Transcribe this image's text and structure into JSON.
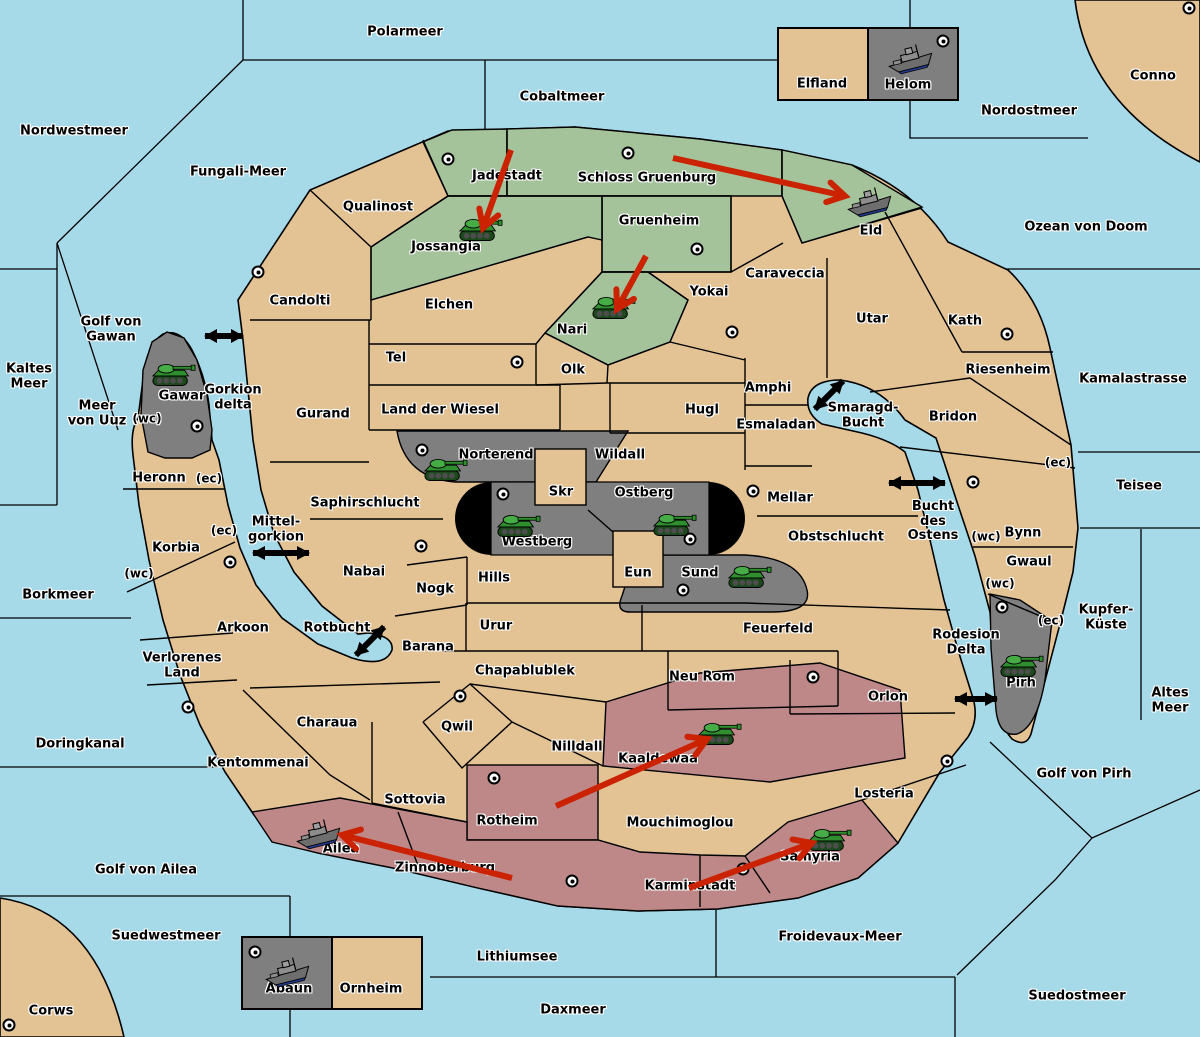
{
  "map_colors": {
    "sea": "#A6DAE8",
    "land": "#E3C294",
    "green": "#A4C39B",
    "red": "#BE8888",
    "gray": "#7F7F7F",
    "black": "#000000",
    "arrow_red": "#CB2201"
  },
  "sea_labels": [
    {
      "text": "Polarmeer",
      "x": 405,
      "y": 33
    },
    {
      "text": "Cobaltmeer",
      "x": 562,
      "y": 98
    },
    {
      "text": "Nordostmeer",
      "x": 1029,
      "y": 112
    },
    {
      "text": "Nordwestmeer",
      "x": 74,
      "y": 132
    },
    {
      "text": "Fungali-Meer",
      "x": 238,
      "y": 173
    },
    {
      "text": "Ozean von Doom",
      "x": 1086,
      "y": 228
    },
    {
      "text": "Kamalastrasse",
      "x": 1133,
      "y": 380
    },
    {
      "text": "Kaltes\nMeer",
      "x": 29,
      "y": 377
    },
    {
      "text": "Golf von\nGawan",
      "x": 111,
      "y": 330
    },
    {
      "text": "Meer\nvon Uuz",
      "x": 97,
      "y": 414
    },
    {
      "text": "Gorkion\ndelta",
      "x": 233,
      "y": 398
    },
    {
      "text": "Mittel-\ngorkion",
      "x": 276,
      "y": 530
    },
    {
      "text": "Teisee",
      "x": 1139,
      "y": 487
    },
    {
      "text": "Borkmeer",
      "x": 58,
      "y": 596
    },
    {
      "text": "Smaragd-\nBucht",
      "x": 863,
      "y": 416
    },
    {
      "text": "Bucht\ndes\nOstens",
      "x": 933,
      "y": 522
    },
    {
      "text": "Rotbucht",
      "x": 337,
      "y": 629
    },
    {
      "text": "Kupfer-\nKüste",
      "x": 1106,
      "y": 618
    },
    {
      "text": "Altes\nMeer",
      "x": 1170,
      "y": 701
    },
    {
      "text": "Rodesion\nDelta",
      "x": 966,
      "y": 643
    },
    {
      "text": "Doringkanal",
      "x": 80,
      "y": 745
    },
    {
      "text": "Golf von Pirh",
      "x": 1084,
      "y": 775
    },
    {
      "text": "Golf von Ailea",
      "x": 146,
      "y": 871
    },
    {
      "text": "Suedwestmeer",
      "x": 166,
      "y": 937
    },
    {
      "text": "Froidevaux-Meer",
      "x": 840,
      "y": 938
    },
    {
      "text": "Lithiumsee",
      "x": 517,
      "y": 958
    },
    {
      "text": "Daxmeer",
      "x": 573,
      "y": 1011
    },
    {
      "text": "Suedostmeer",
      "x": 1077,
      "y": 997
    }
  ],
  "territories": [
    {
      "name": "Conno",
      "x": 1153,
      "y": 77,
      "kind": "neutral"
    },
    {
      "name": "Corws",
      "x": 51,
      "y": 1012,
      "kind": "neutral"
    },
    {
      "name": "Elfland",
      "x": 822,
      "y": 85,
      "kind": "neutral"
    },
    {
      "name": "Helom",
      "x": 908,
      "y": 86,
      "kind": "gray"
    },
    {
      "name": "Abaun",
      "x": 289,
      "y": 990,
      "kind": "gray"
    },
    {
      "name": "Ornheim",
      "x": 371,
      "y": 990,
      "kind": "neutral"
    },
    {
      "name": "Qualinost",
      "x": 378,
      "y": 208,
      "kind": "neutral"
    },
    {
      "name": "Candolti",
      "x": 300,
      "y": 302,
      "kind": "neutral"
    },
    {
      "name": "Jadestadt",
      "x": 507,
      "y": 177,
      "kind": "green"
    },
    {
      "name": "Schloss Gruenburg",
      "x": 647,
      "y": 179,
      "kind": "green"
    },
    {
      "name": "Gruenheim",
      "x": 659,
      "y": 222,
      "kind": "green"
    },
    {
      "name": "Jossangia",
      "x": 446,
      "y": 248,
      "kind": "green"
    },
    {
      "name": "Nari",
      "x": 572,
      "y": 331,
      "kind": "green"
    },
    {
      "name": "Eld",
      "x": 871,
      "y": 232,
      "kind": "green"
    },
    {
      "name": "Elchen",
      "x": 449,
      "y": 306,
      "kind": "neutral"
    },
    {
      "name": "Tel",
      "x": 396,
      "y": 359,
      "kind": "neutral"
    },
    {
      "name": "Olk",
      "x": 573,
      "y": 371,
      "kind": "neutral"
    },
    {
      "name": "Yokai",
      "x": 709,
      "y": 293,
      "kind": "neutral"
    },
    {
      "name": "Caraveccia",
      "x": 785,
      "y": 275,
      "kind": "neutral"
    },
    {
      "name": "Gurand",
      "x": 323,
      "y": 415,
      "kind": "neutral"
    },
    {
      "name": "Land der Wiesel",
      "x": 440,
      "y": 411,
      "kind": "neutral"
    },
    {
      "name": "Hugl",
      "x": 702,
      "y": 411,
      "kind": "neutral"
    },
    {
      "name": "Amphi",
      "x": 768,
      "y": 389,
      "kind": "neutral"
    },
    {
      "name": "Esmaladan",
      "x": 776,
      "y": 426,
      "kind": "neutral"
    },
    {
      "name": "Utar",
      "x": 872,
      "y": 320,
      "kind": "neutral"
    },
    {
      "name": "Kath",
      "x": 965,
      "y": 322,
      "kind": "neutral"
    },
    {
      "name": "Riesenheim",
      "x": 1008,
      "y": 371,
      "kind": "neutral"
    },
    {
      "name": "Bridon",
      "x": 953,
      "y": 418,
      "kind": "neutral"
    },
    {
      "name": "Gawar",
      "x": 182,
      "y": 397,
      "kind": "gray"
    },
    {
      "name": "Norterend",
      "x": 496,
      "y": 456,
      "kind": "gray"
    },
    {
      "name": "Skr",
      "x": 561,
      "y": 493,
      "kind": "neutral"
    },
    {
      "name": "Ostberg",
      "x": 644,
      "y": 494,
      "kind": "gray"
    },
    {
      "name": "Westberg",
      "x": 537,
      "y": 543,
      "kind": "gray"
    },
    {
      "name": "Wildall",
      "x": 620,
      "y": 456,
      "kind": "neutral"
    },
    {
      "name": "Mellar",
      "x": 790,
      "y": 499,
      "kind": "neutral"
    },
    {
      "name": "Obstschlucht",
      "x": 836,
      "y": 538,
      "kind": "neutral"
    },
    {
      "name": "Saphirschlucht",
      "x": 365,
      "y": 504,
      "kind": "neutral"
    },
    {
      "name": "Heronn",
      "x": 159,
      "y": 479,
      "kind": "neutral"
    },
    {
      "name": "Korbia",
      "x": 176,
      "y": 549,
      "kind": "neutral"
    },
    {
      "name": "Nabai",
      "x": 364,
      "y": 573,
      "kind": "neutral"
    },
    {
      "name": "Nogk",
      "x": 435,
      "y": 590,
      "kind": "neutral"
    },
    {
      "name": "Hills",
      "x": 494,
      "y": 579,
      "kind": "neutral"
    },
    {
      "name": "Eun",
      "x": 638,
      "y": 574,
      "kind": "neutral"
    },
    {
      "name": "Sund",
      "x": 700,
      "y": 574,
      "kind": "gray"
    },
    {
      "name": "Arkoon",
      "x": 243,
      "y": 629,
      "kind": "neutral"
    },
    {
      "name": "Verlorenes\nLand",
      "x": 182,
      "y": 666,
      "kind": "neutral"
    },
    {
      "name": "Barana",
      "x": 428,
      "y": 648,
      "kind": "neutral"
    },
    {
      "name": "Urur",
      "x": 496,
      "y": 627,
      "kind": "neutral"
    },
    {
      "name": "Chapablublek",
      "x": 525,
      "y": 672,
      "kind": "neutral"
    },
    {
      "name": "Feuerfeld",
      "x": 778,
      "y": 630,
      "kind": "neutral"
    },
    {
      "name": "Neu Rom",
      "x": 702,
      "y": 678,
      "kind": "neutral"
    },
    {
      "name": "Bynn",
      "x": 1023,
      "y": 534,
      "kind": "neutral"
    },
    {
      "name": "Gwaul",
      "x": 1029,
      "y": 563,
      "kind": "neutral"
    },
    {
      "name": "Pirh",
      "x": 1021,
      "y": 684,
      "kind": "gray"
    },
    {
      "name": "Orlon",
      "x": 888,
      "y": 698,
      "kind": "neutral"
    },
    {
      "name": "Losteria",
      "x": 884,
      "y": 795,
      "kind": "neutral"
    },
    {
      "name": "Charaua",
      "x": 327,
      "y": 724,
      "kind": "neutral"
    },
    {
      "name": "Kentommenai",
      "x": 258,
      "y": 764,
      "kind": "neutral"
    },
    {
      "name": "Qwil",
      "x": 457,
      "y": 728,
      "kind": "neutral"
    },
    {
      "name": "Nilldall",
      "x": 577,
      "y": 748,
      "kind": "neutral"
    },
    {
      "name": "Sottovia",
      "x": 415,
      "y": 801,
      "kind": "neutral"
    },
    {
      "name": "Rotheim",
      "x": 507,
      "y": 822,
      "kind": "red"
    },
    {
      "name": "Kaaldewaa",
      "x": 658,
      "y": 760,
      "kind": "red"
    },
    {
      "name": "Mouchimoglou",
      "x": 680,
      "y": 824,
      "kind": "neutral"
    },
    {
      "name": "Zinnoberburg",
      "x": 445,
      "y": 869,
      "kind": "red"
    },
    {
      "name": "Karminstadt",
      "x": 690,
      "y": 887,
      "kind": "red"
    },
    {
      "name": "Ailea",
      "x": 341,
      "y": 850,
      "kind": "red"
    },
    {
      "name": "Samyria",
      "x": 810,
      "y": 858,
      "kind": "red"
    }
  ],
  "supply_centers": [
    {
      "territory": "Conno",
      "x": 1189,
      "y": 8
    },
    {
      "territory": "Helom",
      "x": 943,
      "y": 41
    },
    {
      "territory": "Jadestadt",
      "x": 448,
      "y": 159
    },
    {
      "territory": "Schloss Gruenburg",
      "x": 628,
      "y": 153
    },
    {
      "territory": "Gruenheim",
      "x": 697,
      "y": 249
    },
    {
      "territory": "Candolti",
      "x": 258,
      "y": 272
    },
    {
      "territory": "Yokai",
      "x": 732,
      "y": 332
    },
    {
      "territory": "Kath",
      "x": 1007,
      "y": 334
    },
    {
      "territory": "Tel",
      "x": 517,
      "y": 362
    },
    {
      "territory": "Gawar",
      "x": 197,
      "y": 426
    },
    {
      "territory": "Norterend",
      "x": 422,
      "y": 450
    },
    {
      "territory": "Westberg",
      "x": 503,
      "y": 494
    },
    {
      "territory": "Mellar",
      "x": 753,
      "y": 491
    },
    {
      "territory": "Ostberg",
      "x": 690,
      "y": 539
    },
    {
      "territory": "Nabai",
      "x": 421,
      "y": 546
    },
    {
      "territory": "Arkoon",
      "x": 230,
      "y": 562
    },
    {
      "territory": "Sund",
      "x": 683,
      "y": 590
    },
    {
      "territory": "Bynn",
      "x": 973,
      "y": 482
    },
    {
      "territory": "Pirh",
      "x": 1002,
      "y": 607
    },
    {
      "territory": "Qwil",
      "x": 460,
      "y": 696
    },
    {
      "territory": "Neu Rom",
      "x": 813,
      "y": 677
    },
    {
      "territory": "Kentommenai",
      "x": 188,
      "y": 707
    },
    {
      "territory": "Losteria",
      "x": 947,
      "y": 761
    },
    {
      "territory": "Rotheim",
      "x": 494,
      "y": 778
    },
    {
      "territory": "Zinnoberburg",
      "x": 572,
      "y": 881
    },
    {
      "territory": "Karminstadt",
      "x": 743,
      "y": 869
    },
    {
      "territory": "Abaun",
      "x": 255,
      "y": 952
    },
    {
      "territory": "Corws",
      "x": 9,
      "y": 1025
    }
  ],
  "coast_labels": [
    {
      "text": "(wc)",
      "x": 147,
      "y": 419
    },
    {
      "text": "(ec)",
      "x": 209,
      "y": 479
    },
    {
      "text": "(ec)",
      "x": 224,
      "y": 531
    },
    {
      "text": "(wc)",
      "x": 139,
      "y": 574
    },
    {
      "text": "(ec)",
      "x": 1058,
      "y": 463
    },
    {
      "text": "(wc)",
      "x": 986,
      "y": 537
    },
    {
      "text": "(wc)",
      "x": 1000,
      "y": 584
    },
    {
      "text": "(ec)",
      "x": 1051,
      "y": 621
    }
  ],
  "units": [
    {
      "kind": "army",
      "territory": "Jossangia",
      "x": 480,
      "y": 229
    },
    {
      "kind": "army",
      "territory": "Nari",
      "x": 613,
      "y": 307
    },
    {
      "kind": "army",
      "territory": "Gawar",
      "x": 173,
      "y": 374
    },
    {
      "kind": "army",
      "territory": "Norterend",
      "x": 445,
      "y": 469
    },
    {
      "kind": "army",
      "territory": "Westberg",
      "x": 518,
      "y": 525
    },
    {
      "kind": "army",
      "territory": "Ostberg",
      "x": 674,
      "y": 524
    },
    {
      "kind": "army",
      "territory": "Sund",
      "x": 749,
      "y": 576
    },
    {
      "kind": "army",
      "territory": "Pirh",
      "x": 1021,
      "y": 665
    },
    {
      "kind": "army",
      "territory": "Kaaldewaa",
      "x": 719,
      "y": 733
    },
    {
      "kind": "army",
      "territory": "Samyria",
      "x": 829,
      "y": 839
    },
    {
      "kind": "fleet",
      "territory": "Helom",
      "x": 911,
      "y": 58
    },
    {
      "kind": "fleet",
      "territory": "Eld",
      "x": 870,
      "y": 201
    },
    {
      "kind": "fleet",
      "territory": "Ailea",
      "x": 319,
      "y": 833
    },
    {
      "kind": "fleet",
      "territory": "Abaun",
      "x": 288,
      "y": 971
    }
  ],
  "move_arrows": [
    {
      "from": "Jadestadt",
      "to": "Jossangia",
      "x1": 511,
      "y1": 150,
      "x2": 483,
      "y2": 228
    },
    {
      "from": "Schloss Gruenburg",
      "to": "Eld",
      "x1": 673,
      "y1": 158,
      "x2": 845,
      "y2": 196
    },
    {
      "from": "Gruenheim",
      "to": "Nari",
      "x1": 646,
      "y1": 256,
      "x2": 617,
      "y2": 309
    },
    {
      "from": "Rotheim",
      "to": "Kaaldewaa",
      "x1": 556,
      "y1": 806,
      "x2": 707,
      "y2": 739
    },
    {
      "from": "Zinnoberburg",
      "to": "Ailea",
      "x1": 512,
      "y1": 878,
      "x2": 342,
      "y2": 835
    },
    {
      "from": "Karminstadt",
      "to": "Samyria",
      "x1": 689,
      "y1": 888,
      "x2": 812,
      "y2": 843
    }
  ],
  "strait_arrows": [
    {
      "name": "gorkion-delta-strait",
      "x": 224,
      "y": 336,
      "angle": 0,
      "len": 38
    },
    {
      "name": "mittelgorkion-strait",
      "x": 281,
      "y": 553,
      "angle": 0,
      "len": 56
    },
    {
      "name": "rotbucht-strait",
      "x": 370,
      "y": 641,
      "angle": -45,
      "len": 40
    },
    {
      "name": "smaragd-bucht-strait",
      "x": 829,
      "y": 395,
      "angle": -45,
      "len": 40
    },
    {
      "name": "bucht-des-ostens-strait",
      "x": 917,
      "y": 483,
      "angle": 0,
      "len": 56
    },
    {
      "name": "rodesion-delta-strait",
      "x": 976,
      "y": 699,
      "angle": 0,
      "len": 42
    }
  ]
}
